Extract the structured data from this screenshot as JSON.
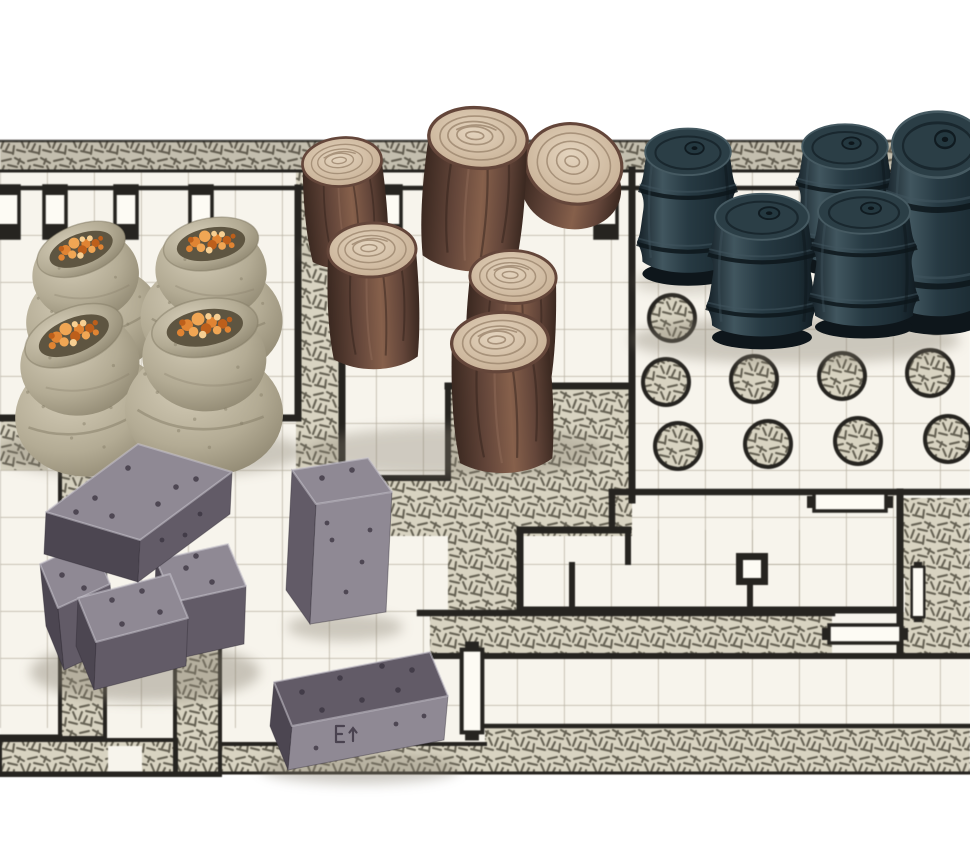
{
  "meta": {
    "description": "Photograph of miniature tabletop dungeon accessories arranged on a black-and-white hand-drawn dungeon map mat",
    "background": "#ffffff",
    "mat_area": {
      "top": 141,
      "bottom": 773
    }
  },
  "palette": {
    "paper": "#f7f4ec",
    "hatchBg": "#d8d3c1",
    "hatchLine": "#575346",
    "wall": "#262420",
    "grid": "#a39c8b",
    "sackLight": "#d5cdb8",
    "sackMid": "#b3ab94",
    "sackDark": "#847c66",
    "sackInner": "#5e5541",
    "grainDark": "#bd5f1b",
    "grainMid": "#e08433",
    "grainLight": "#f0a654",
    "grainPale": "#f7cf92",
    "barkDark": "#3a2820",
    "barkMid": "#64463a",
    "barkLight": "#86604b",
    "logTopLight": "#e4d4be",
    "logTopMid": "#c8b196",
    "logRing": "#a08a72",
    "barrelDark": "#141f26",
    "barrelMid": "#273a43",
    "barrelLight": "#41565f",
    "barrelTop": "#2b3e46",
    "ingotTop": "#8f8994",
    "ingotFront": "#625b67",
    "ingotSide": "#4c4651",
    "ingotHi": "#c9c5ce",
    "ingotPit": "#38323e",
    "shadow": "#867f70"
  },
  "map": {
    "pillars": [
      [
        672,
        318
      ],
      [
        760,
        315
      ],
      [
        848,
        312
      ],
      [
        936,
        310
      ],
      [
        666,
        382
      ],
      [
        754,
        379
      ],
      [
        842,
        376
      ],
      [
        930,
        373
      ],
      [
        678,
        446
      ],
      [
        768,
        444
      ],
      [
        858,
        441
      ],
      [
        948,
        439
      ]
    ],
    "pilasters": [
      8,
      55,
      126,
      201,
      390,
      606
    ],
    "doors": [
      {
        "x": 850,
        "y": 502,
        "o": "h",
        "s": 1.0
      },
      {
        "x": 865,
        "y": 634,
        "o": "h",
        "s": 1.0
      },
      {
        "x": 472,
        "y": 691,
        "o": "v",
        "s": 1.15
      },
      {
        "x": 918,
        "y": 592,
        "o": "v",
        "s": 0.7
      }
    ]
  },
  "shadows": [
    [
      150,
      452,
      155,
      26,
      0.38
    ],
    [
      345,
      252,
      48,
      10,
      0.22
    ],
    [
      455,
      452,
      150,
      26,
      0.35
    ],
    [
      688,
      282,
      55,
      12,
      0.28
    ],
    [
      795,
      340,
      165,
      24,
      0.38
    ],
    [
      145,
      672,
      115,
      30,
      0.42
    ],
    [
      345,
      627,
      58,
      14,
      0.38
    ],
    [
      360,
      768,
      100,
      16,
      0.4
    ]
  ],
  "objects": {
    "grain_sacks": {
      "count": 4,
      "items": [
        {
          "x": 92,
          "y": 300,
          "s": 0.92,
          "r": -6
        },
        {
          "x": 213,
          "y": 298,
          "s": 0.96,
          "r": 4
        },
        {
          "x": 88,
          "y": 392,
          "s": 1.03,
          "r": -8
        },
        {
          "x": 206,
          "y": 388,
          "s": 1.07,
          "r": 5
        }
      ]
    },
    "logs": {
      "count": 6,
      "items": [
        {
          "x": 342,
          "y": 162,
          "s": 0.9,
          "r": -5,
          "t": "side"
        },
        {
          "x": 573,
          "y": 168,
          "s": 1.05,
          "r": 12,
          "t": "end"
        },
        {
          "x": 478,
          "y": 138,
          "s": 1.12,
          "r": 4,
          "t": "side"
        },
        {
          "x": 372,
          "y": 250,
          "s": 1.0,
          "r": -2,
          "t": "side"
        },
        {
          "x": 513,
          "y": 277,
          "s": 0.98,
          "r": 2,
          "t": "side"
        },
        {
          "x": 500,
          "y": 342,
          "s": 1.1,
          "r": -3,
          "t": "side"
        }
      ]
    },
    "barrels": {
      "count": 5,
      "items": [
        {
          "x": 688,
          "y": 150,
          "sx": 0.93,
          "sy": 0.93
        },
        {
          "x": 845,
          "y": 145,
          "sx": 0.93,
          "sy": 0.9
        },
        {
          "x": 938,
          "y": 142,
          "sx": 1.0,
          "sy": 1.32
        },
        {
          "x": 762,
          "y": 215,
          "sx": 1.02,
          "sy": 0.92
        },
        {
          "x": 864,
          "y": 210,
          "sx": 1.0,
          "sy": 0.88
        }
      ]
    },
    "ingots": {
      "count": 6,
      "items": [
        {
          "name": "pile-left-lower",
          "top": "40,564 92,540 110,584 58,608",
          "front": "58,608 110,584 116,646 64,670",
          "side": "40,564 58,608 64,670 46,626",
          "pits": [
            [
              62,
              575
            ],
            [
              84,
              588
            ]
          ]
        },
        {
          "name": "pile-right-cube",
          "top": "156,560 228,544 246,586 174,602",
          "front": "174,602 246,586 244,644 172,660",
          "side": "156,560 174,602 172,660 154,618",
          "pits": [
            [
              186,
              568
            ],
            [
              212,
              582
            ],
            [
              196,
              556
            ]
          ]
        },
        {
          "name": "pile-mid-front",
          "top": "78,598 170,574 188,618 96,642",
          "front": "96,642 188,618 186,666 94,690",
          "side": "78,598 96,642 94,690 76,646",
          "pits": [
            [
              112,
              600
            ],
            [
              142,
              591
            ],
            [
              160,
              612
            ],
            [
              122,
              624
            ]
          ]
        },
        {
          "name": "pile-top-bar",
          "top": "46,512 138,444 232,472 140,540",
          "front": "140,540 232,472 230,514 138,582",
          "side": "46,512 140,540 138,582 44,554",
          "pits": [
            [
              95,
              498
            ],
            [
              128,
              468
            ],
            [
              176,
              487
            ],
            [
              112,
              516
            ],
            [
              158,
              504
            ],
            [
              196,
              479
            ],
            [
              76,
              512
            ]
          ],
          "fpits": [
            [
              162,
              540
            ],
            [
              200,
              514
            ],
            [
              185,
              535
            ]
          ]
        },
        {
          "name": "standing-block",
          "top": "292,470 368,458 392,492 316,504",
          "front": "316,504 392,492 386,612 310,624",
          "side": "292,470 316,504 310,624 286,590",
          "pits": [
            [
              322,
              478
            ],
            [
              352,
              470
            ]
          ],
          "fpits": [
            [
              332,
              540
            ],
            [
              362,
              562
            ],
            [
              346,
              592
            ],
            [
              327,
              523
            ],
            [
              370,
              530
            ]
          ],
          "ov": {
            "front": "ingotTop",
            "side": "ingotFront"
          }
        },
        {
          "name": "lying-block",
          "top": "274,682 430,652 448,696 292,726",
          "front": "292,726 448,696 444,740 288,770",
          "side": "274,682 292,726 288,770 270,726",
          "pits": [
            [
              302,
              692
            ],
            [
              340,
              678
            ],
            [
              382,
              666
            ],
            [
              412,
              670
            ],
            [
              322,
              710
            ],
            [
              362,
              700
            ],
            [
              398,
              690
            ]
          ],
          "fpits": [
            [
              316,
              748
            ],
            [
              396,
              724
            ],
            [
              424,
              716
            ]
          ],
          "stamp": [
            336,
            726
          ],
          "ov": {
            "front": "ingotTop",
            "top": "ingotFront"
          }
        }
      ]
    }
  }
}
